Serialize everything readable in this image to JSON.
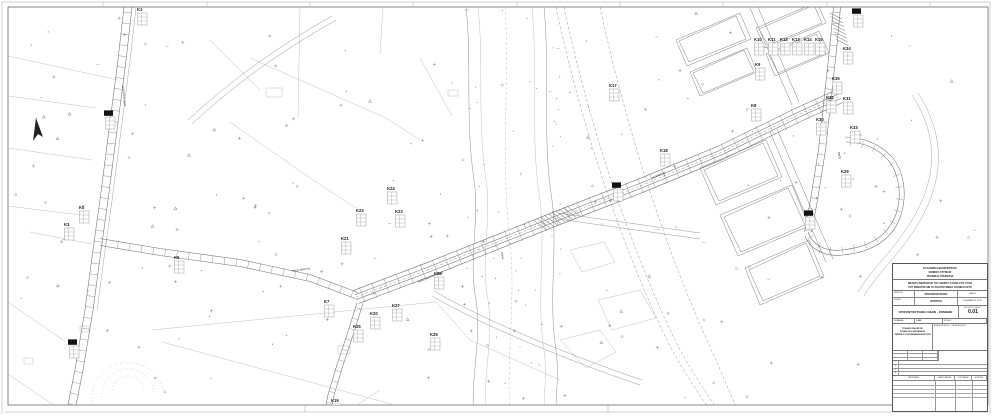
{
  "map": {
    "markers": [
      {
        "id": "K1",
        "x": 137,
        "y": 11
      },
      {
        "id": "K2",
        "x": 105,
        "y": 115,
        "filled": true
      },
      {
        "id": "K3",
        "x": 64,
        "y": 226
      },
      {
        "id": "K4",
        "x": 69,
        "y": 344,
        "filled": true
      },
      {
        "id": "K5",
        "x": 79,
        "y": 209
      },
      {
        "id": "K6",
        "x": 174,
        "y": 259
      },
      {
        "id": "K7",
        "x": 324,
        "y": 303
      },
      {
        "id": "K8",
        "x": 751,
        "y": 107
      },
      {
        "id": "K9",
        "x": 755,
        "y": 66
      },
      {
        "id": "K10",
        "x": 754,
        "y": 41
      },
      {
        "id": "K11",
        "x": 768,
        "y": 41
      },
      {
        "id": "K12",
        "x": 780,
        "y": 41
      },
      {
        "id": "K13",
        "x": 792,
        "y": 41
      },
      {
        "id": "K14",
        "x": 804,
        "y": 41
      },
      {
        "id": "K15",
        "x": 815,
        "y": 41
      },
      {
        "id": "K16",
        "x": 613,
        "y": 187,
        "filled": true
      },
      {
        "id": "K17",
        "x": 609,
        "y": 87
      },
      {
        "id": "K18",
        "x": 660,
        "y": 152
      },
      {
        "id": "K19",
        "x": 331,
        "y": 402
      },
      {
        "id": "K20",
        "x": 370,
        "y": 315
      },
      {
        "id": "K21",
        "x": 341,
        "y": 240
      },
      {
        "id": "K22",
        "x": 356,
        "y": 212
      },
      {
        "id": "K23",
        "x": 395,
        "y": 213
      },
      {
        "id": "K24",
        "x": 387,
        "y": 190
      },
      {
        "id": "K25",
        "x": 353,
        "y": 328
      },
      {
        "id": "K25",
        "x": 430,
        "y": 336
      },
      {
        "id": "K26",
        "x": 434,
        "y": 275
      },
      {
        "id": "K27",
        "x": 392,
        "y": 307
      },
      {
        "id": "K28",
        "x": 805,
        "y": 215,
        "filled": true
      },
      {
        "id": "K29",
        "x": 841,
        "y": 173
      },
      {
        "id": "K30",
        "x": 816,
        "y": 121
      },
      {
        "id": "K31",
        "x": 843,
        "y": 100
      },
      {
        "id": "K32",
        "x": 826,
        "y": 99
      },
      {
        "id": "K33",
        "x": 850,
        "y": 129
      },
      {
        "id": "K34",
        "x": 843,
        "y": 50
      },
      {
        "id": "K35",
        "x": 853,
        "y": 13,
        "filled": true
      },
      {
        "id": "K36",
        "x": 832,
        "y": 80
      }
    ],
    "road_labels": [
      {
        "text": "ΠΑΡΑΠΛΕΥΡΟΣ ΟΔΟΣ",
        "x": 418,
        "y": 283,
        "rot": -22
      },
      {
        "text": "ΛΕΩΦΟΡΟΣ",
        "x": 652,
        "y": 179,
        "rot": -23
      },
      {
        "text": "ΑΓΡΟΤΙΚΗ ΟΔΟΣ",
        "x": 122,
        "y": 86,
        "rot": 84
      },
      {
        "text": "ΡΕΜΑ",
        "x": 501,
        "y": 252,
        "rot": 82
      },
      {
        "text": "ΟΔΟΣ",
        "x": 838,
        "y": 152,
        "rot": 82
      },
      {
        "text": "ΠΡΟΣ ΚΕΝΤΡΟ",
        "x": 292,
        "y": 272,
        "rot": -8
      }
    ]
  },
  "title_block": {
    "agency": [
      "ΕΛΛΗΝΙΚΗ ΔΗΜΟΚΡΑΤΙΑ",
      "ΝΟΜΟΣ ΑΤΤΙΚΗΣ",
      "ΤΕΧΝΙΚΗ ΥΠΗΡΕΣΙΑ"
    ],
    "project": [
      "ΜΕΛΕΤΗ ΒΕΛΤΙΩΣΗΣ ΤΟΥ ΟΔΙΚΟΥ ΑΞΟΝΑ ΣΤΟ ΥΨΟΣ",
      "ΤΟΥ ΡΕΜΑΤΟΣ ΜΕ ΤΑ ΑΠΑΙΤΟΥΜΕΝΑ ΤΕΧΝΙΚΑ ΕΡΓΑ"
    ],
    "field_rows": [
      {
        "label": "ΜΕΛΕΤΗ",
        "value": "ΟΡΙΖΟΝΤΙΟΓΡΑΦΙΑ",
        "right": "ΦΑΣΗ"
      },
      {
        "label": "ΣΤΑΔΙΟ",
        "value": "ΟΡΙΣΤΙΚΗ",
        "right": "ΝΟΕΜΒΡΙΟΣ 2011"
      }
    ],
    "drawing_title": "ΟΡΙΖΟΝΤΙΟΓΡΑΦΙΑ ΟΔΩΝ - ΚΟΜΒΩΝ",
    "number_label": "ΑΡΙΘΜΟΣ ΣΧΕΔΙΟΥ",
    "drawing_number": "0.01",
    "scale_label": "ΚΛΙΜΑΚΑ",
    "scale_value": "1:500",
    "sheet_label": "ΦΥΛΛΟ",
    "consultant": [
      "ΓΡΑΦΕΙΟ ΜΕΛΕΤΩΝ",
      "ΣΥΜΒΟΥΛΟΙ ΜΗΧΑΝΙΚΟΙ",
      "ΤΜΗΜΑ ΣΥΓΚΟΙΝΩΝΙΑΚΩΝ ΕΡΓΩΝ"
    ],
    "revisions_label": "ΑΝΑΘΕΩΡΗΣΕΙΣ - ΠΑΡΑΤΗΡΗΣΕΙΣ",
    "list_rows": [
      "1",
      "2",
      "3",
      "4"
    ],
    "bottom_table_headers": [
      "ΠΕΡΙΓΡΑΦΗ",
      "ΗΜΕΡΟΜΗΝΙΑ",
      "ΥΠΟΓΡΑΦΗ",
      "ΕΓΚΡΙΣΗ"
    ]
  },
  "colors": {
    "label_ink": "#111111",
    "line_gray": "#8a8a8a"
  }
}
